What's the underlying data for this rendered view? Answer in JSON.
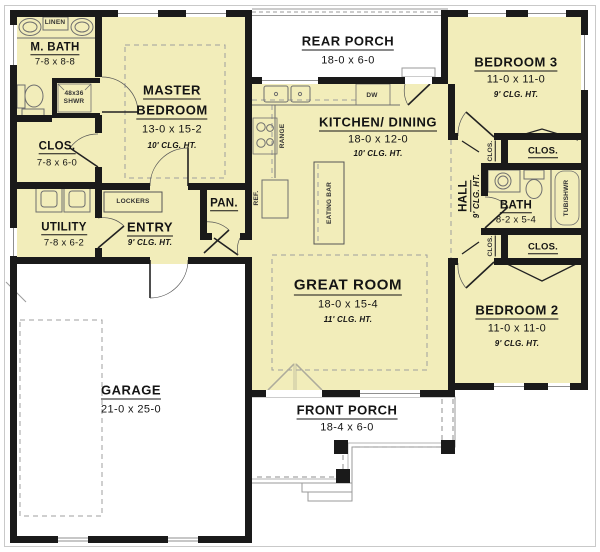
{
  "rooms": {
    "m_bath": {
      "name": "M. BATH",
      "dims": "7-8 x 8-8"
    },
    "m_clos": {
      "name": "CLOS.",
      "dims": "7-8 x 6-0"
    },
    "master": {
      "line1": "MASTER",
      "line2": "BEDROOM",
      "dims": "13-0 x 15-2",
      "clg": "10' CLG. HT."
    },
    "rear_porch": {
      "name": "REAR PORCH",
      "dims": "18-0 x 6-0"
    },
    "bedroom3": {
      "name": "BEDROOM 3",
      "dims": "11-0 x 11-0",
      "clg": "9' CLG. HT."
    },
    "kitchen": {
      "name": "KITCHEN/ DINING",
      "dims": "18-0 x 12-0",
      "clg": "10' CLG. HT."
    },
    "utility": {
      "name": "UTILITY",
      "dims": "7-8 x 6-2"
    },
    "entry": {
      "name": "ENTRY",
      "clg": "9' CLG. HT."
    },
    "pantry": {
      "name": "PAN."
    },
    "hall": {
      "name": "HALL",
      "clg": "9' CLG. HT."
    },
    "bath": {
      "name": "BATH",
      "dims": "8-2 x 5-4"
    },
    "clos_hall_top": {
      "name": "CLOS."
    },
    "clos_bedroom3": {
      "name": "CLOS."
    },
    "clos_hall_bottom": {
      "name": "CLOS."
    },
    "clos_bedroom2": {
      "name": "CLOS."
    },
    "great_room": {
      "name": "GREAT ROOM",
      "dims": "18-0 x 15-4",
      "clg": "11' CLG. HT."
    },
    "bedroom2": {
      "name": "BEDROOM 2",
      "dims": "11-0 x 11-0",
      "clg": "9' CLG. HT."
    },
    "garage": {
      "name": "GARAGE",
      "dims": "21-0 x 25-0"
    },
    "front_porch": {
      "name": "FRONT PORCH",
      "dims": "18-4 x 6-0"
    }
  },
  "fixtures": {
    "linen": "LINEN",
    "shower_size": "48x36",
    "shower": "SHWR",
    "lockers": "LOCKERS",
    "range": "RANGE",
    "ref": "REF.",
    "dw": "DW",
    "eating_bar": "EATING BAR",
    "tub": "TUB/SHWR"
  },
  "colors": {
    "floor": "#f2edba",
    "wall": "#1a1a1a",
    "porch_floor": "#ffffff",
    "line_gray": "#8f8f8f"
  }
}
